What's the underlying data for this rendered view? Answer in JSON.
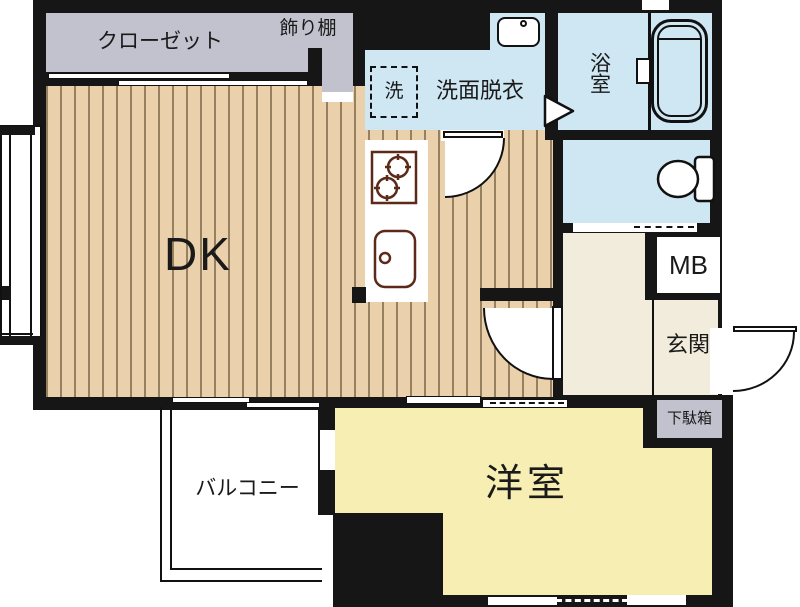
{
  "colors": {
    "background": "#ffffff",
    "wall": "#161616",
    "wood_floor": "#ebd1ab",
    "wood_stripe": "#97805f",
    "wet_area_blue": "#cfe6f3",
    "western_room_yellow": "#f6eeb2",
    "hallway_cream": "#f2ecdd",
    "closet_gray": "#c2c2ce",
    "fixture_outline_brown": "#5d2a1a"
  },
  "rooms": {
    "dining_kitchen": {
      "label": "DK"
    },
    "western_room": {
      "label": "洋室"
    },
    "balcony": {
      "label": "バルコニー"
    },
    "entrance": {
      "label": "玄関"
    },
    "shoe_cabinet": {
      "label": "下駄箱"
    },
    "meter_box": {
      "label": "MB"
    },
    "closet": {
      "label": "クローゼット"
    },
    "display_shelf": {
      "label": "飾り棚"
    },
    "washroom": {
      "label": "洗面脱衣"
    },
    "washer_space": {
      "label": "洗"
    },
    "bathroom": {
      "label": "浴室"
    }
  }
}
